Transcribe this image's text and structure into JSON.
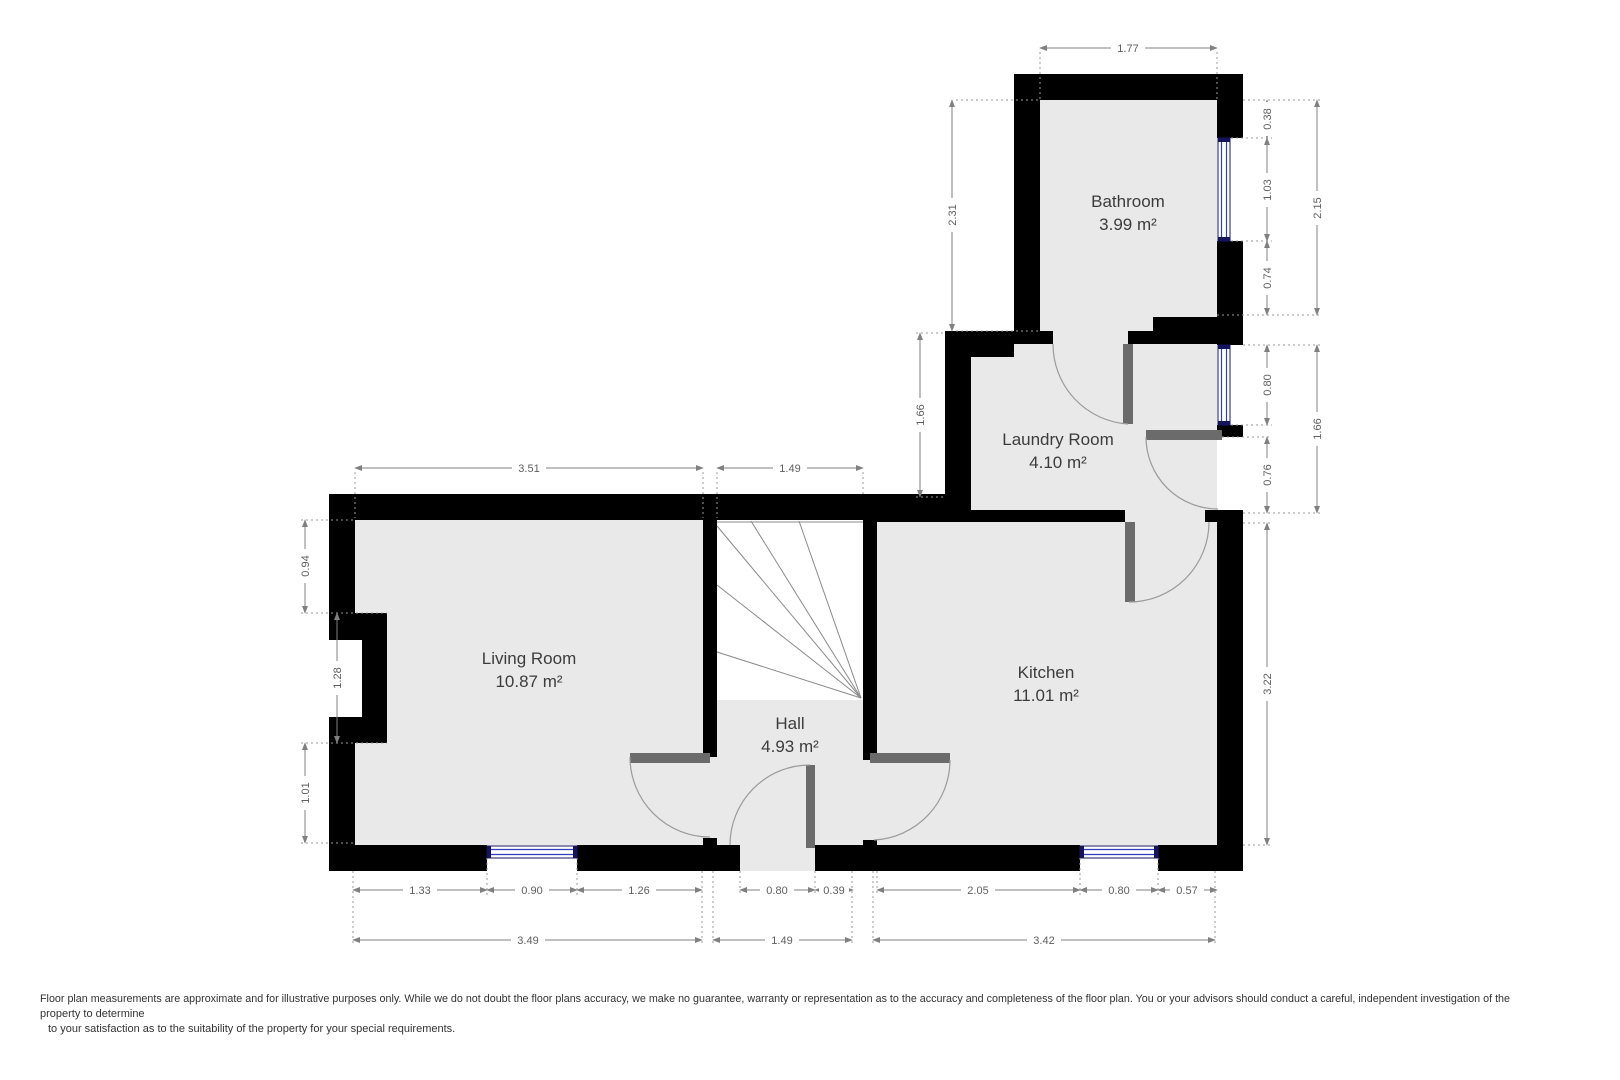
{
  "rooms": {
    "bathroom": {
      "name": "Bathroom",
      "area": "3.99 m²"
    },
    "laundry_room": {
      "name": "Laundry Room",
      "area": "4.10 m²"
    },
    "living_room": {
      "name": "Living Room",
      "area": "10.87 m²"
    },
    "hall": {
      "name": "Hall",
      "area": "4.93 m²"
    },
    "kitchen": {
      "name": "Kitchen",
      "area": "11.01 m²"
    }
  },
  "dims": {
    "top_bathroom_width": "1.77",
    "bathroom_left_height": "2.31",
    "bathroom_right_seg1": "0.38",
    "bathroom_right_window": "1.03",
    "bathroom_right_seg2": "0.74",
    "bathroom_right_total": "2.15",
    "laundry_right_window": "0.80",
    "laundry_right_door": "0.76",
    "laundry_right_total": "1.66",
    "laundry_left_height": "1.66",
    "living_top_width": "3.51",
    "stairs_top_width": "1.49",
    "living_left_seg1": "0.94",
    "living_left_chimney": "1.28",
    "living_left_seg2": "1.01",
    "kitchen_right_height": "3.22",
    "living_bottom_seg1": "1.33",
    "living_bottom_window": "0.90",
    "living_bottom_seg2": "1.26",
    "hall_bottom_door": "0.80",
    "hall_bottom_seg": "0.39",
    "kitchen_bottom_seg1": "2.05",
    "kitchen_bottom_window": "0.80",
    "kitchen_bottom_seg2": "0.57",
    "living_bottom_total": "3.49",
    "hall_bottom_total": "1.49",
    "kitchen_bottom_total": "3.42"
  },
  "disclaimer": {
    "line1": "Floor plan measurements are approximate and for illustrative purposes only. While we do not doubt the floor plans accuracy, we make no guarantee, warranty or representation as to the accuracy and completeness of the floor plan. You or your advisors should conduct a careful, independent investigation of the",
    "line2": "property to determine",
    "line3": "to your satisfaction as to the suitability of the property for your special requirements."
  },
  "colors": {
    "wall": "#000000",
    "floor": "#e9e9e9",
    "door_leaf": "#6b6b6b",
    "window_glass": "#2e3fbe",
    "dimension": "#808080",
    "room_text": "#3c3c3c"
  }
}
